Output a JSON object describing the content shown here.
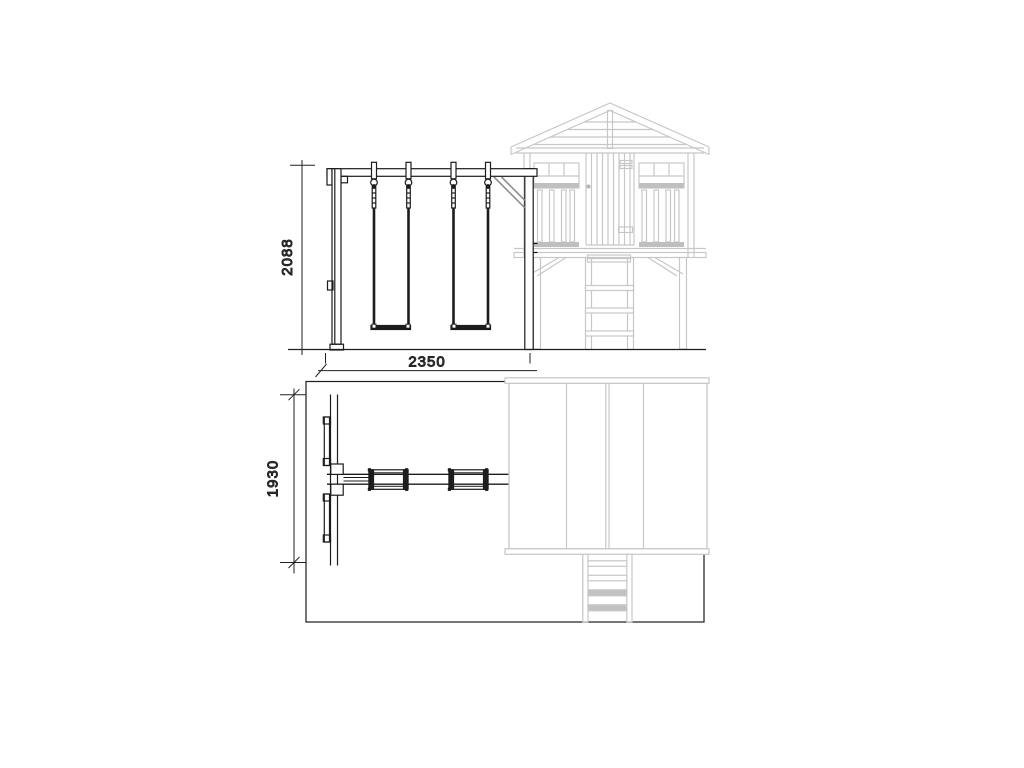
{
  "diagram": {
    "type": "technical-drawing",
    "views": {
      "front_elevation": {
        "dimensions": {
          "height": {
            "value": "2088",
            "orientation": "vertical"
          },
          "width": {
            "value": "2350",
            "orientation": "horizontal"
          }
        }
      },
      "plan": {
        "dimensions": {
          "depth": {
            "value": "1930",
            "orientation": "vertical"
          }
        }
      }
    },
    "colors": {
      "primary_line": "#1c1c1c",
      "secondary_structure": "#c7c7c7",
      "brace": "#8f8f8f",
      "dimension_text": "#3d4c66",
      "dimension_line": "#222222",
      "fill_band": "#bfbfbf"
    }
  }
}
